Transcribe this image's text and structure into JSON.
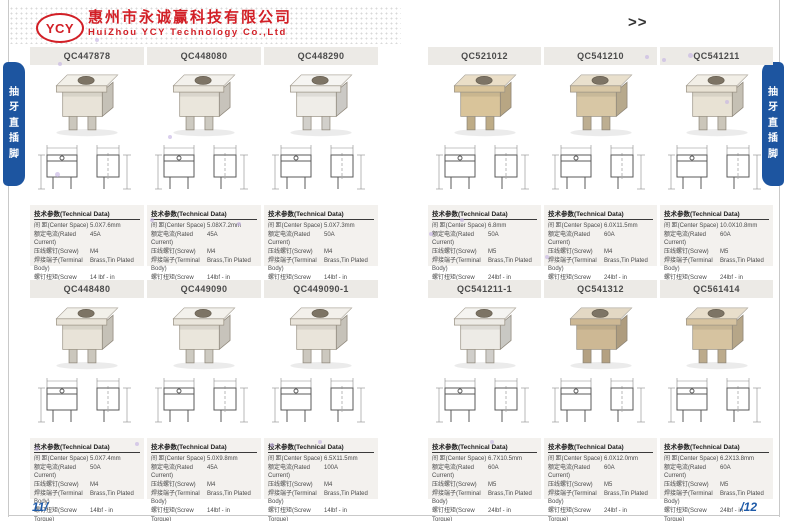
{
  "header": {
    "logo_text": "YCY",
    "company_name_cn": "惠州市永诚赢科技有限公司",
    "company_name_en": "HuiZhou YCY Technology Co.,Ltd",
    "nav_arrows": ">>"
  },
  "side_tabs": {
    "label": "抽牙直插脚",
    "chars": [
      "抽",
      "牙",
      "直",
      "插",
      "脚"
    ]
  },
  "footer": {
    "page_number_left": "11/",
    "page_number_right": "/12"
  },
  "table_labels": {
    "title": "技术参数(Technical Data)",
    "center_space": "间  距(Center Space)",
    "rated_current": "额定电流(Rated Current)",
    "screw": "压线螺钉(Screw)",
    "terminal_body": "焊接端子(Terminal Body)",
    "screw_torque": "螺钉扭矩(Screw Torque)"
  },
  "colors": {
    "brand_red": "#d21f26",
    "tab_blue": "#1d55a0",
    "page_number_blue": "#1e5aa8",
    "title_bar_gray": "#eceae6",
    "table_panel_gray": "#f3f1ee"
  },
  "products": [
    {
      "code": "QC447878",
      "center_space": "5.0X7.6mm",
      "rated_current": "45A",
      "screw": "M4",
      "terminal_body": "Brass,Tin Plated",
      "screw_torque": "14 lbf - in",
      "photo_color": "#e8e3d8"
    },
    {
      "code": "QC448080",
      "center_space": "5.08X7.2mm",
      "rated_current": "45A",
      "screw": "M4",
      "terminal_body": "Brass,Tin Plated",
      "screw_torque": "14lbf - in",
      "photo_color": "#eae6dc"
    },
    {
      "code": "QC448290",
      "center_space": "5.0X7.3mm",
      "rated_current": "50A",
      "screw": "M4",
      "terminal_body": "Brass,Tin Plated",
      "screw_torque": "14lbf - in",
      "photo_color": "#efede8"
    },
    {
      "code": "QC521012",
      "center_space": "6.8mm",
      "rated_current": "50A",
      "screw": "M5",
      "terminal_body": "Brass,Tin Plated",
      "screw_torque": "24lbf - in",
      "photo_color": "#d9c49a"
    },
    {
      "code": "QC541210",
      "center_space": "6.0X11.5mm",
      "rated_current": "60A",
      "screw": "M4",
      "terminal_body": "Brass,Tin Plated",
      "screw_torque": "24lbf - in",
      "photo_color": "#d8c7a5"
    },
    {
      "code": "QC541211",
      "center_space": "10.0X10.8mm",
      "rated_current": "60A",
      "screw": "M5",
      "terminal_body": "Brass,Tin Plated",
      "screw_torque": "24lbf - in",
      "photo_color": "#e8e2d4"
    },
    {
      "code": "QC448480",
      "center_space": "5.0X7.4mm",
      "rated_current": "50A",
      "screw": "M4",
      "terminal_body": "Brass,Tin Plated",
      "screw_torque": "14lbf - in",
      "photo_color": "#e8e3d8"
    },
    {
      "code": "QC449090",
      "center_space": "5.0X9.8mm",
      "rated_current": "45A",
      "screw": "M4",
      "terminal_body": "Brass,Tin Plated",
      "screw_torque": "14lbf - in",
      "photo_color": "#eae6dc"
    },
    {
      "code": "QC449090-1",
      "center_space": "6.5X11.5mm",
      "rated_current": "100A",
      "screw": "M4",
      "terminal_body": "Brass,Tin Plated",
      "screw_torque": "14lbf - in",
      "photo_color": "#e9e4da"
    },
    {
      "code": "QC541211-1",
      "center_space": "6.7X10.5mm",
      "rated_current": "60A",
      "screw": "M5",
      "terminal_body": "Brass,Tin Plated",
      "screw_torque": "24lbf - in",
      "photo_color": "#edebe6"
    },
    {
      "code": "QC541312",
      "center_space": "6.0X12.0mm",
      "rated_current": "60A",
      "screw": "M5",
      "terminal_body": "Brass,Tin Plated",
      "screw_torque": "24lbf - in",
      "photo_color": "#cdb894"
    },
    {
      "code": "QC561414",
      "center_space": "6.2X13.8mm",
      "rated_current": "60A",
      "screw": "M5",
      "terminal_body": "Brass,Tin Plated",
      "screw_torque": "24lbf - in",
      "photo_color": "#d6c3a0"
    }
  ]
}
